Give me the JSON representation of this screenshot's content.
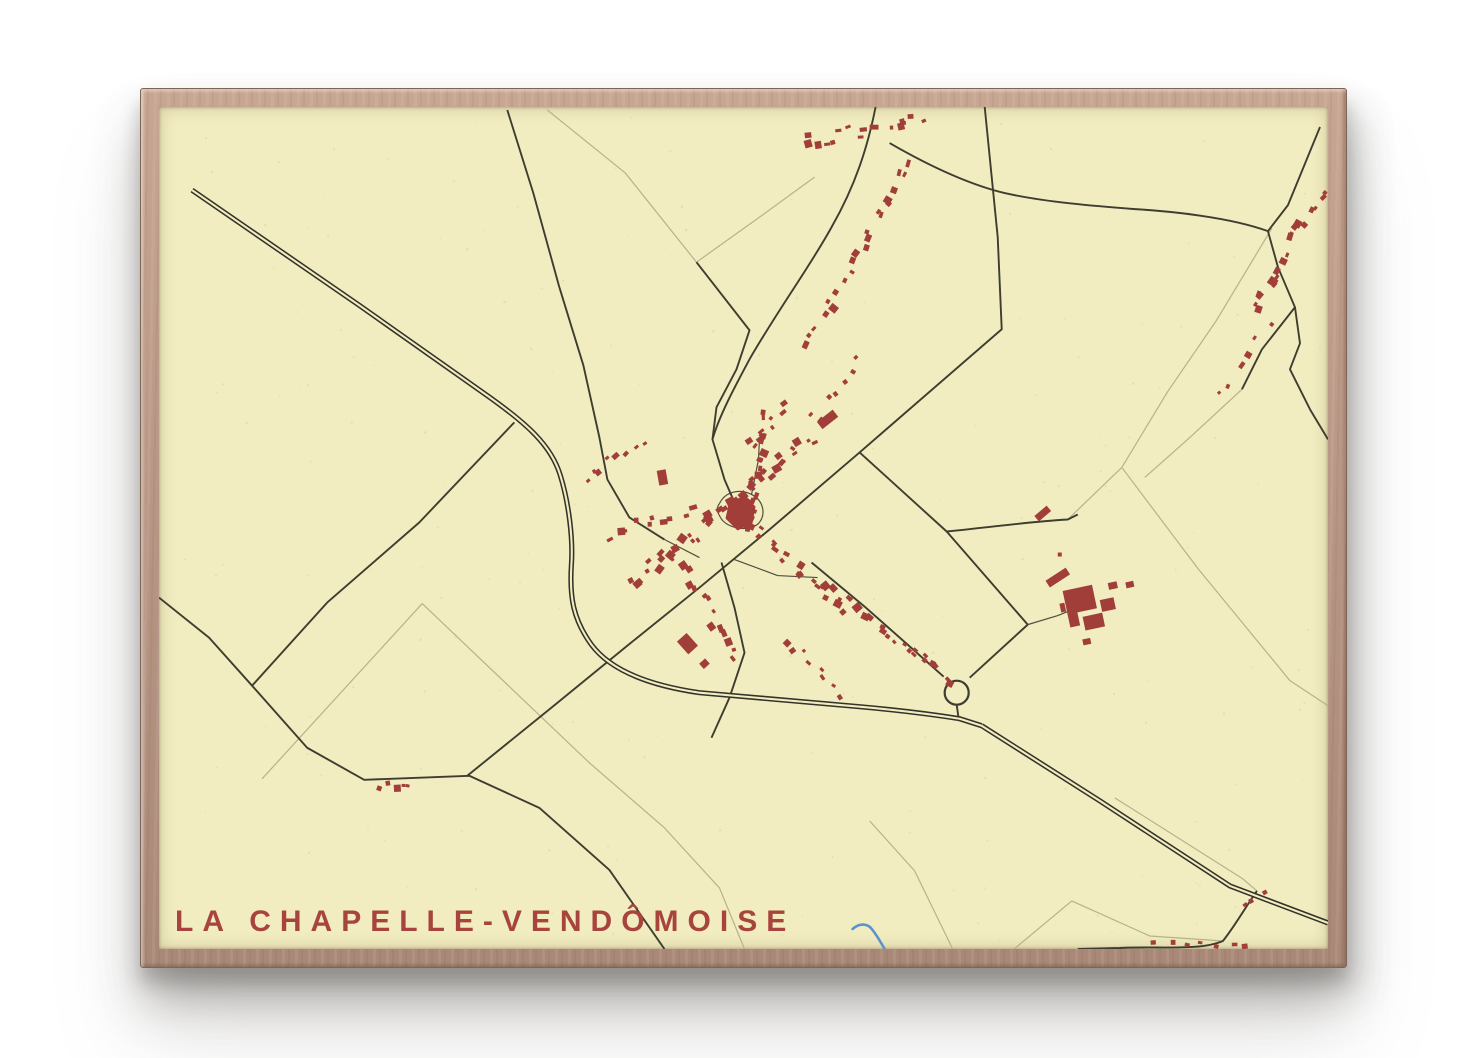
{
  "poster": {
    "title": "LA CHAPELLE-VENDÔMOISE"
  },
  "palette": {
    "page_bg": "#ffffff",
    "frame_wood": "#b99786",
    "frame_edge": "#7e6454",
    "paper": "#f1edc0",
    "road_dark": "#3e3d30",
    "motorway_casing": "#34332a",
    "track": "#b6b28b",
    "building": "#a23e39",
    "water": "#5d93cc",
    "title": "#a8443e",
    "speckle": "#ded8a0"
  },
  "map": {
    "width": 1168,
    "height": 841,
    "speckle_count": 240,
    "roundabout": {
      "cx": 797,
      "cy": 585,
      "r": 12
    },
    "motorways": [
      "M 33 83 L 200 198 L 322 284 C 368 316 392 338 401 368 C 409 394 414 430 412 458 C 410 490 414 512 432 537 C 452 564 492 578 540 585 L 700 599 C 745 603 775 607 800 611 L 822 618",
      "M 822 618 L 940 693 L 1070 778 L 1168 815"
    ],
    "roads": [
      "M 825 0 L 838 130 L 842 222 L 700 345 L 610 422 L 540 480 L 468 538 L 392 600 L 308 668",
      "M 355 315 L 260 415 L 168 495 L 93 578",
      "M 0 490 L 50 530 L 93 578 L 148 640 L 205 672 L 310 668 L 380 700 L 450 762 L 505 841",
      "M 716 0 C 708 40 696 78 672 120 C 650 160 620 200 590 252 C 575 280 560 308 553 332 L 565 372 L 578 402",
      "M 348 3 L 374 86 L 400 180 L 424 258 L 440 330 L 448 372 L 470 410 L 505 432",
      "M 730 36 C 775 62 812 78 845 86 C 885 95 935 99 975 102 C 1010 104 1070 110 1108 124",
      "M 1160 20 L 1128 98 L 1108 124 L 1118 160 L 1135 200 L 1140 236 L 1130 262 L 1150 302 L 1168 332",
      "M 1135 200 L 1102 242 L 1082 282",
      "M 537 155 L 590 223 L 577 262 L 557 300 L 553 332",
      "M 700 345 L 787 424 L 868 517",
      "M 868 517 L 810 570",
      "M 652 455 L 705 499 L 748 537 L 784 569",
      "M 787 424 C 830 420 870 414 908 412 L 918 407",
      "M 562 455 L 575 500 L 585 545 L 570 590 L 552 630",
      "M 1097 783 C 1085 800 1075 818 1063 833 C 1040 843 1000 838 960 840 L 918 841",
      "M 797 597 L 799 611"
    ],
    "lanes": [
      "M 560 396 C 566 384 580 381 592 387 C 604 393 607 407 599 416 C 589 425 567 421 561 410 C 557 403 557 400 560 396",
      "M 592 387 L 599 352 L 600 330",
      "M 575 452 L 618 468 L 658 470",
      "M 868 517 L 898 508 L 918 500",
      "M 505 432 L 540 450"
    ],
    "tracks": [
      "M 263 496 L 430 655 L 505 720 L 560 780 L 585 841",
      "M 263 496 L 103 671",
      "M 388 3 L 466 66 L 537 155",
      "M 537 155 L 600 110 L 655 70",
      "M 908 412 L 962 360 L 1008 284 L 1056 214",
      "M 962 360 L 1038 461 L 1130 573 L 1168 598",
      "M 1112 121 L 1056 214",
      "M 710 713 L 755 763 L 793 841",
      "M 852 843 L 912 793 L 990 828 L 1063 833",
      "M 955 690 L 1083 771 L 1097 783",
      "M 1082 282 L 1030 330 L 985 370"
    ],
    "stream": "M 693 821 C 700 815 708 815 713 822 C 719 830 722 836 725 841",
    "church": "570,393 586,389 596,399 593,416 578,423 566,411",
    "buildings": [
      {
        "x": 668,
        "y": 312,
        "w": 20,
        "h": 9,
        "rot": -38
      },
      {
        "x": 898,
        "y": 470,
        "w": 24,
        "h": 8,
        "rot": -33
      },
      {
        "x": 920,
        "y": 492,
        "w": 30,
        "h": 24,
        "rot": -12
      },
      {
        "x": 948,
        "y": 497,
        "w": 14,
        "h": 12,
        "rot": -12
      },
      {
        "x": 934,
        "y": 514,
        "w": 20,
        "h": 14,
        "rot": -12
      },
      {
        "x": 914,
        "y": 512,
        "w": 10,
        "h": 14,
        "rot": -12
      },
      {
        "x": 953,
        "y": 478,
        "w": 9,
        "h": 7,
        "rot": -12
      },
      {
        "x": 970,
        "y": 477,
        "w": 8,
        "h": 6,
        "rot": -12
      },
      {
        "x": 903,
        "y": 500,
        "w": 5,
        "h": 9,
        "rot": -12
      },
      {
        "x": 927,
        "y": 534,
        "w": 8,
        "h": 6,
        "rot": -12
      },
      {
        "x": 528,
        "y": 536,
        "w": 13,
        "h": 17,
        "rot": -42
      },
      {
        "x": 545,
        "y": 556,
        "w": 8,
        "h": 7,
        "rot": -42
      },
      {
        "x": 883,
        "y": 406,
        "w": 16,
        "h": 7,
        "rot": -40
      },
      {
        "x": 900,
        "y": 447,
        "w": 4,
        "h": 4,
        "rot": 0
      },
      {
        "x": 503,
        "y": 370,
        "w": 9,
        "h": 15,
        "rot": -10
      }
    ],
    "clusters": [
      {
        "cx": 705,
        "cy": 23,
        "angle": -12,
        "len": 130,
        "count": 16,
        "spread": 13,
        "smin": 4,
        "smax": 9
      },
      {
        "cx": 722,
        "cy": 100,
        "angle": -62,
        "len": 100,
        "count": 12,
        "spread": 13,
        "smin": 4,
        "smax": 8
      },
      {
        "cx": 672,
        "cy": 195,
        "angle": -55,
        "len": 95,
        "count": 10,
        "spread": 11,
        "smin": 4,
        "smax": 8
      },
      {
        "cx": 1128,
        "cy": 142,
        "angle": -58,
        "len": 150,
        "count": 20,
        "spread": 17,
        "smin": 4,
        "smax": 9
      },
      {
        "cx": 565,
        "cy": 402,
        "angle": -40,
        "len": 240,
        "count": 42,
        "spread": 16,
        "smin": 4,
        "smax": 9
      },
      {
        "cx": 632,
        "cy": 456,
        "angle": 40,
        "len": 150,
        "count": 22,
        "spread": 14,
        "smin": 4,
        "smax": 8
      },
      {
        "cx": 598,
        "cy": 362,
        "angle": -78,
        "len": 110,
        "count": 16,
        "spread": 12,
        "smin": 4,
        "smax": 8
      },
      {
        "cx": 488,
        "cy": 415,
        "angle": -15,
        "len": 85,
        "count": 10,
        "spread": 12,
        "smin": 4,
        "smax": 8
      },
      {
        "cx": 548,
        "cy": 500,
        "angle": 62,
        "len": 120,
        "count": 14,
        "spread": 12,
        "smin": 4,
        "smax": 8
      },
      {
        "cx": 722,
        "cy": 520,
        "angle": 38,
        "len": 120,
        "count": 14,
        "spread": 12,
        "smin": 4,
        "smax": 8
      },
      {
        "cx": 455,
        "cy": 352,
        "angle": -35,
        "len": 70,
        "count": 8,
        "spread": 10,
        "smin": 4,
        "smax": 7
      },
      {
        "cx": 678,
        "cy": 277,
        "angle": -50,
        "len": 70,
        "count": 6,
        "spread": 10,
        "smin": 4,
        "smax": 7
      },
      {
        "cx": 236,
        "cy": 678,
        "angle": 5,
        "len": 30,
        "count": 5,
        "spread": 8,
        "smin": 4,
        "smax": 7
      },
      {
        "cx": 1040,
        "cy": 836,
        "angle": 0,
        "len": 95,
        "count": 7,
        "spread": 5,
        "smin": 4,
        "smax": 7
      },
      {
        "cx": 1093,
        "cy": 790,
        "angle": -35,
        "len": 26,
        "count": 3,
        "spread": 6,
        "smin": 4,
        "smax": 6
      },
      {
        "cx": 1085,
        "cy": 252,
        "angle": -55,
        "len": 80,
        "count": 6,
        "spread": 12,
        "smin": 4,
        "smax": 7
      },
      {
        "cx": 655,
        "cy": 560,
        "angle": 45,
        "len": 80,
        "count": 8,
        "spread": 10,
        "smin": 4,
        "smax": 7
      },
      {
        "cx": 607,
        "cy": 318,
        "angle": -45,
        "len": 60,
        "count": 8,
        "spread": 10,
        "smin": 4,
        "smax": 7
      },
      {
        "cx": 770,
        "cy": 556,
        "angle": 38,
        "len": 56,
        "count": 7,
        "spread": 9,
        "smin": 4,
        "smax": 7
      }
    ]
  }
}
